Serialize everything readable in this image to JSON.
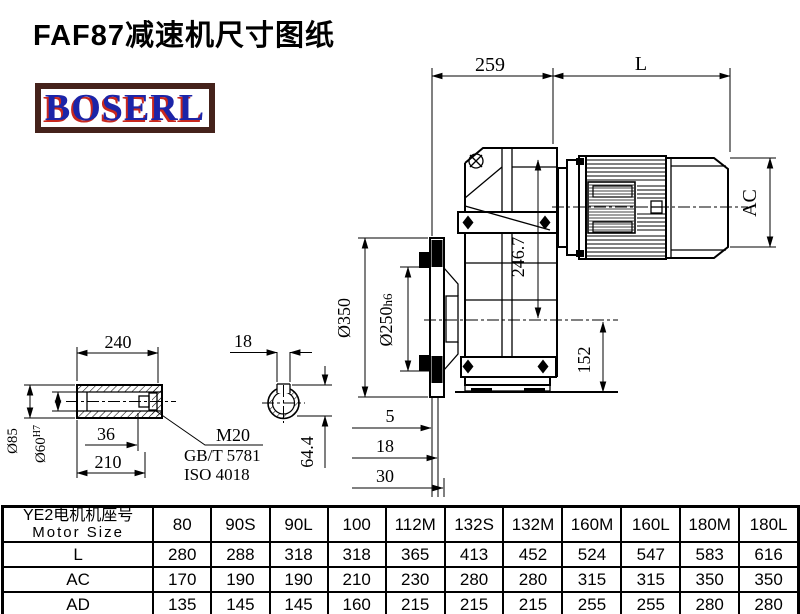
{
  "title": "FAF87减速机尺寸图纸",
  "logo": {
    "text": "BOSERL",
    "border_color": "#45221b",
    "text_color": "#1c24a8",
    "shadow_color": "#c9281e"
  },
  "dims": {
    "d259": "259",
    "dL": "L",
    "dAC": "AC",
    "d246": "246.7",
    "d152": "152",
    "d350": "Ø350",
    "d250": "Ø250",
    "d250tol": "h6",
    "d5": "5",
    "d18a": "18",
    "d30": "30",
    "d240": "240",
    "d36": "36",
    "d210": "210",
    "d85": "Ø85",
    "d60": "Ø60",
    "d60tol": "H7",
    "m20": "M20",
    "gb": "GB/T 5781",
    "iso": "ISO 4018",
    "d18b": "18",
    "d644": "64.4"
  },
  "table": {
    "row_header_cn": "YE2电机机座号",
    "row_header_en": "Motor Size",
    "columns": [
      "80",
      "90S",
      "90L",
      "100",
      "112M",
      "132S",
      "132M",
      "160M",
      "160L",
      "180M",
      "180L"
    ],
    "rows": [
      {
        "label": "L",
        "values": [
          "280",
          "288",
          "318",
          "318",
          "365",
          "413",
          "452",
          "524",
          "547",
          "583",
          "616"
        ]
      },
      {
        "label": "AC",
        "values": [
          "170",
          "190",
          "190",
          "210",
          "230",
          "280",
          "280",
          "315",
          "315",
          "350",
          "350"
        ]
      },
      {
        "label": "AD",
        "values": [
          "135",
          "145",
          "145",
          "160",
          "215",
          "215",
          "215",
          "255",
          "255",
          "280",
          "280"
        ]
      }
    ]
  }
}
